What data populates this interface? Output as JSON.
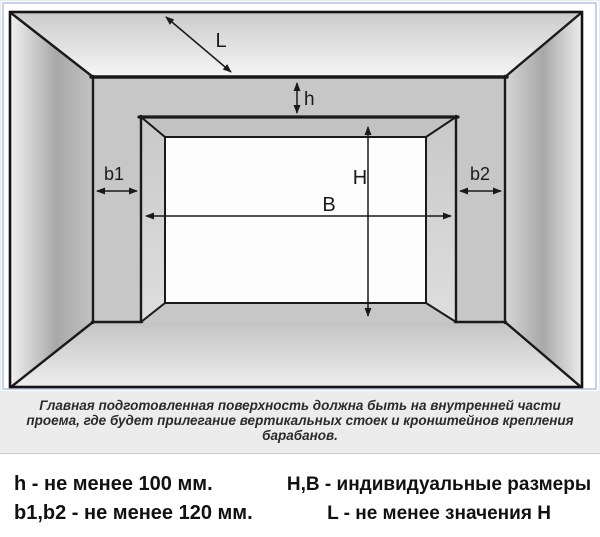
{
  "figure": {
    "dim_labels": {
      "L": "L",
      "h": "h",
      "b1": "b1",
      "b2": "b2",
      "B": "B",
      "H": "H"
    },
    "caption": {
      "line1": "Главная подготовленная поверхность должна быть на внутренней части",
      "line2": "проема, где будет прилегание вертикальных стоек и кронштейнов крепления",
      "line3": "барабанов."
    }
  },
  "legend": {
    "left": [
      "h - не менее 100 мм.",
      "b1,b2 - не менее 120 мм."
    ],
    "right": [
      "H,B - индивидуальные размеры",
      "L - не менее значения H"
    ]
  },
  "colors": {
    "frame_blue": "#b9c6e2",
    "wall_gray": "#c7c7c7",
    "line_black": "#1a1a1a",
    "caption_bg": "#ececec",
    "text_black": "#111111"
  }
}
